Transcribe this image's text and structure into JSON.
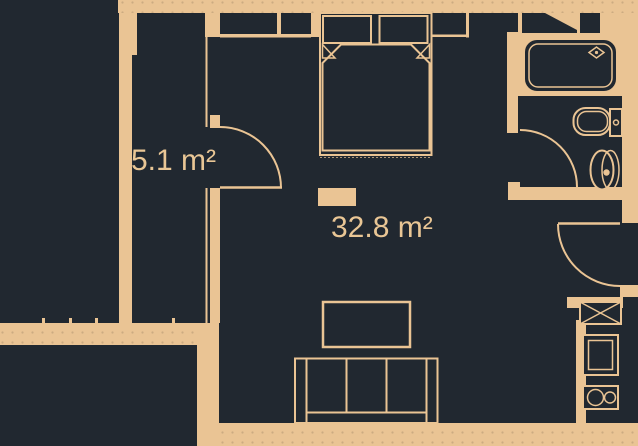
{
  "colors": {
    "background": "#212830",
    "wall": "#eac494",
    "line": "#eac494",
    "dot": "rgba(0,0,0,0.13)",
    "text": "#e9c695"
  },
  "rooms": {
    "small": {
      "area_label": "5.1 m²"
    },
    "main": {
      "area_label": "32.8 m²"
    }
  },
  "fixtures": [
    "double-bed",
    "pillow",
    "duvet",
    "door-swing",
    "coffee-table",
    "sofa",
    "bathtub",
    "bathtub-faucet",
    "toilet",
    "washbasin",
    "kitchen-cabinet",
    "kitchen-sink",
    "cooktop"
  ]
}
